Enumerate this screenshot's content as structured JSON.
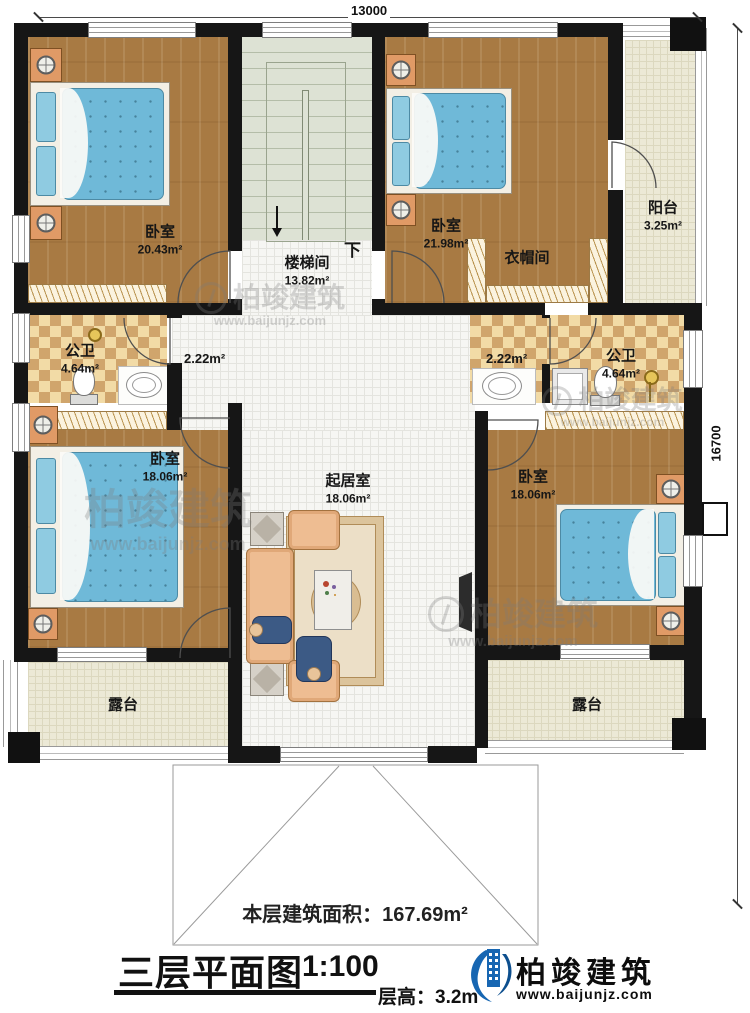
{
  "dimensions": {
    "width_label": "13000",
    "height_label": "16700"
  },
  "rooms": {
    "bedroom_top_left": {
      "name": "卧室",
      "area": "20.43m²"
    },
    "stairwell": {
      "name": "楼梯间",
      "area": "13.82m²",
      "down_label": "下"
    },
    "bedroom_top_right": {
      "name": "卧室",
      "area": "21.98m²"
    },
    "cloakroom": {
      "name": "衣帽间"
    },
    "balcony": {
      "name": "阳台",
      "area": "3.25m²"
    },
    "bathroom_left": {
      "name": "公卫",
      "area": "4.64m²"
    },
    "vestibule_left": {
      "area": "2.22m²"
    },
    "vestibule_right": {
      "area": "2.22m²"
    },
    "bathroom_right": {
      "name": "公卫",
      "area": "4.64m²"
    },
    "bedroom_left": {
      "name": "卧室",
      "area": "18.06m²"
    },
    "living_room": {
      "name": "起居室",
      "area": "18.06m²"
    },
    "bedroom_right": {
      "name": "卧室",
      "area": "18.06m²"
    },
    "terrace_left": {
      "name": "露台"
    },
    "terrace_right": {
      "name": "露台"
    }
  },
  "floor_area_note": "本层建筑面积：167.69m²",
  "title_block": {
    "title": "三层平面图",
    "scale": "1:100",
    "floor_height": "层高：3.2m"
  },
  "brand": {
    "name": "柏竣建筑",
    "url": "www.baijunjz.com"
  },
  "watermark": {
    "name": "柏竣建筑",
    "url": "www.baijunjz.com"
  },
  "colors": {
    "wall": "#161616",
    "wood_floor": "#a87a43",
    "bed_blue": "#6fb9d8",
    "brand_blue": "#1766b2"
  }
}
